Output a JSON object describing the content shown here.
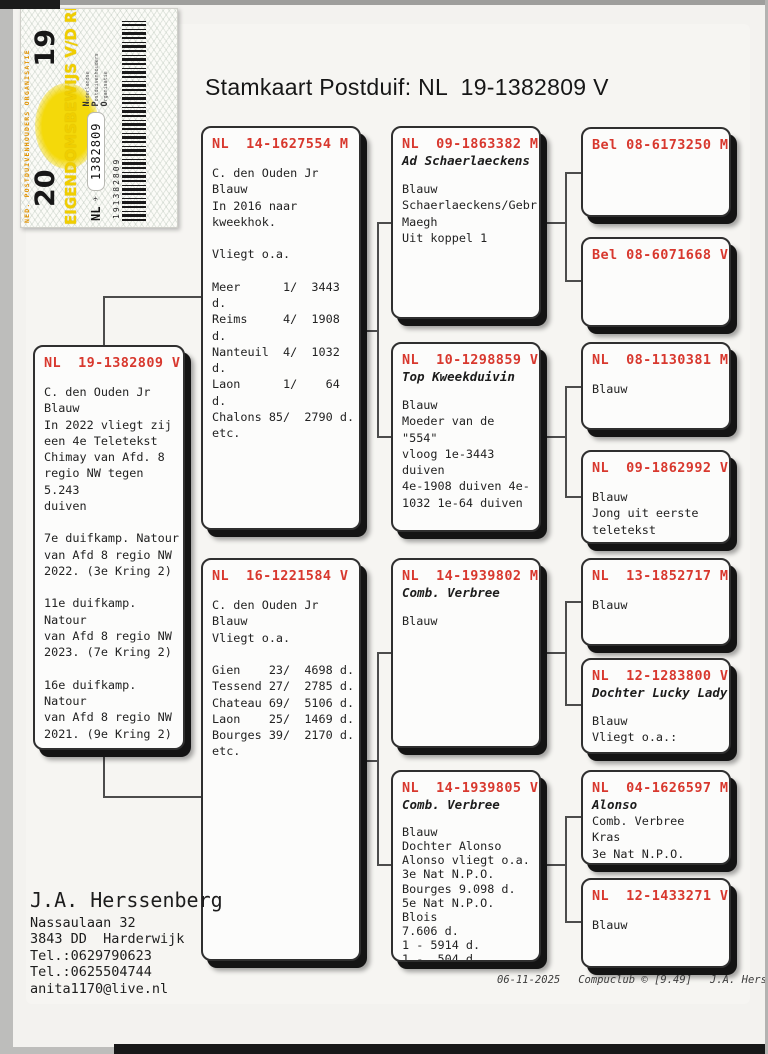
{
  "title": "Stamkaart Postduif: NL  19-1382809 V",
  "sticker": {
    "org_small": "NED. POSTDUIVENHOUDERS ORGANISATIE",
    "year_left": "20",
    "year_right": "19",
    "band": "EIGENDOMSBEWIJS V/D RING",
    "country": "NL",
    "plane_icon": "✈",
    "ring_number": "1382809",
    "org_words": [
      "Nederlandse",
      "Postduivenhouders",
      "Organisatie"
    ],
    "barcode_number": "191382809"
  },
  "boxes": [
    {
      "ring": "NL  19-1382809 V",
      "body": "C. den Ouden Jr\nBlauw\nIn 2022 vliegt zij\neen 4e Teletekst\nChimay van Afd. 8\nregio NW tegen 5.243\nduiven\n\n7e duifkamp. Natour\nvan Afd 8 regio NW\n2022. (3e Kring 2)\n\n11e duifkamp. Natour\nvan Afd 8 regio NW\n2023. (7e Kring 2)\n\n16e duifkamp. Natour\nvan Afd 8 regio NW\n2021. (9e Kring 2)\n\n9e duifkamp.\nGeneraal Snelheid\nAfd 8 regio NW\n2021. (4e Kring 2)"
    },
    {
      "ring": "NL  14-1627554 M",
      "body": "C. den Ouden Jr\nBlauw\nIn 2016 naar\nkweekhok.\n\nVliegt o.a.\n\nMeer      1/  3443 d.\nReims     4/  1908 d.\nNanteuil  4/  1032 d.\nLaon      1/    64 d.\nChalons 85/  2790 d.\netc."
    },
    {
      "ring": "NL  16-1221584 V",
      "body": "C. den Ouden Jr\nBlauw\nVliegt o.a.\n\nGien    23/  4698 d.\nTessend 27/  2785 d.\nChateau 69/  5106 d.\nLaon    25/  1469 d.\nBourges 39/  2170 d.\netc."
    },
    {
      "ring": "NL  09-1863382 M",
      "subtitle": "Ad Schaerlaeckens",
      "body": "Blauw\nSchaerlaeckens/Gebr.\nMaegh\nUit koppel 1"
    },
    {
      "ring": "NL  10-1298859 V",
      "subtitle": "Top Kweekduivin",
      "body": "Blauw\nMoeder van de \"554\"\nvloog 1e-3443 duiven\n4e-1908 duiven 4e-\n1032 1e-64 duiven"
    },
    {
      "ring": "NL  14-1939802 M",
      "subtitle": "Comb. Verbree",
      "body": "Blauw"
    },
    {
      "ring": "NL  14-1939805 V",
      "subtitle": "Comb. Verbree",
      "body": "Blauw\nDochter Alonso\nAlonso vliegt o.a.\n3e Nat N.P.O.\nBourges 9.098 d.\n5e Nat N.P.O. Blois\n7.606 d.\n1 - 5914 d.\n1 -  504 d.\n1 -  255 d.\n4 - 4512 d."
    },
    {
      "ring": "Bel 08-6173250 M",
      "body": ""
    },
    {
      "ring": "Bel 08-6071668 V",
      "body": ""
    },
    {
      "ring": "NL  08-1130381 M",
      "body": "Blauw"
    },
    {
      "ring": "NL  09-1862992 V",
      "body": "Blauw\nJong uit eerste\nteletekst"
    },
    {
      "ring": "NL  13-1852717 M",
      "body": "Blauw"
    },
    {
      "ring": "NL  12-1283800 V",
      "subtitle": "Dochter Lucky Lady",
      "body": "Blauw\nVliegt o.a.:"
    },
    {
      "ring": "NL  04-1626597 M",
      "subtitle": "Alonso",
      "body": "Comb. Verbree\nKras\n3e Nat N.P.O.\nBourges 9.098 d."
    },
    {
      "ring": "NL  12-1433271 V",
      "body": "Blauw"
    }
  ],
  "owner": {
    "name": "J.A. Herssenberg",
    "address": "Nassaulaan 32\n3843 DD  Harderwijk\nTel.:0629790623\nTel.:0625504744\nanita1170@live.nl"
  },
  "footer": {
    "date": "06-11-2025",
    "program": "Compuclub © [9.49]",
    "name": "J.A. Herssenberg"
  }
}
